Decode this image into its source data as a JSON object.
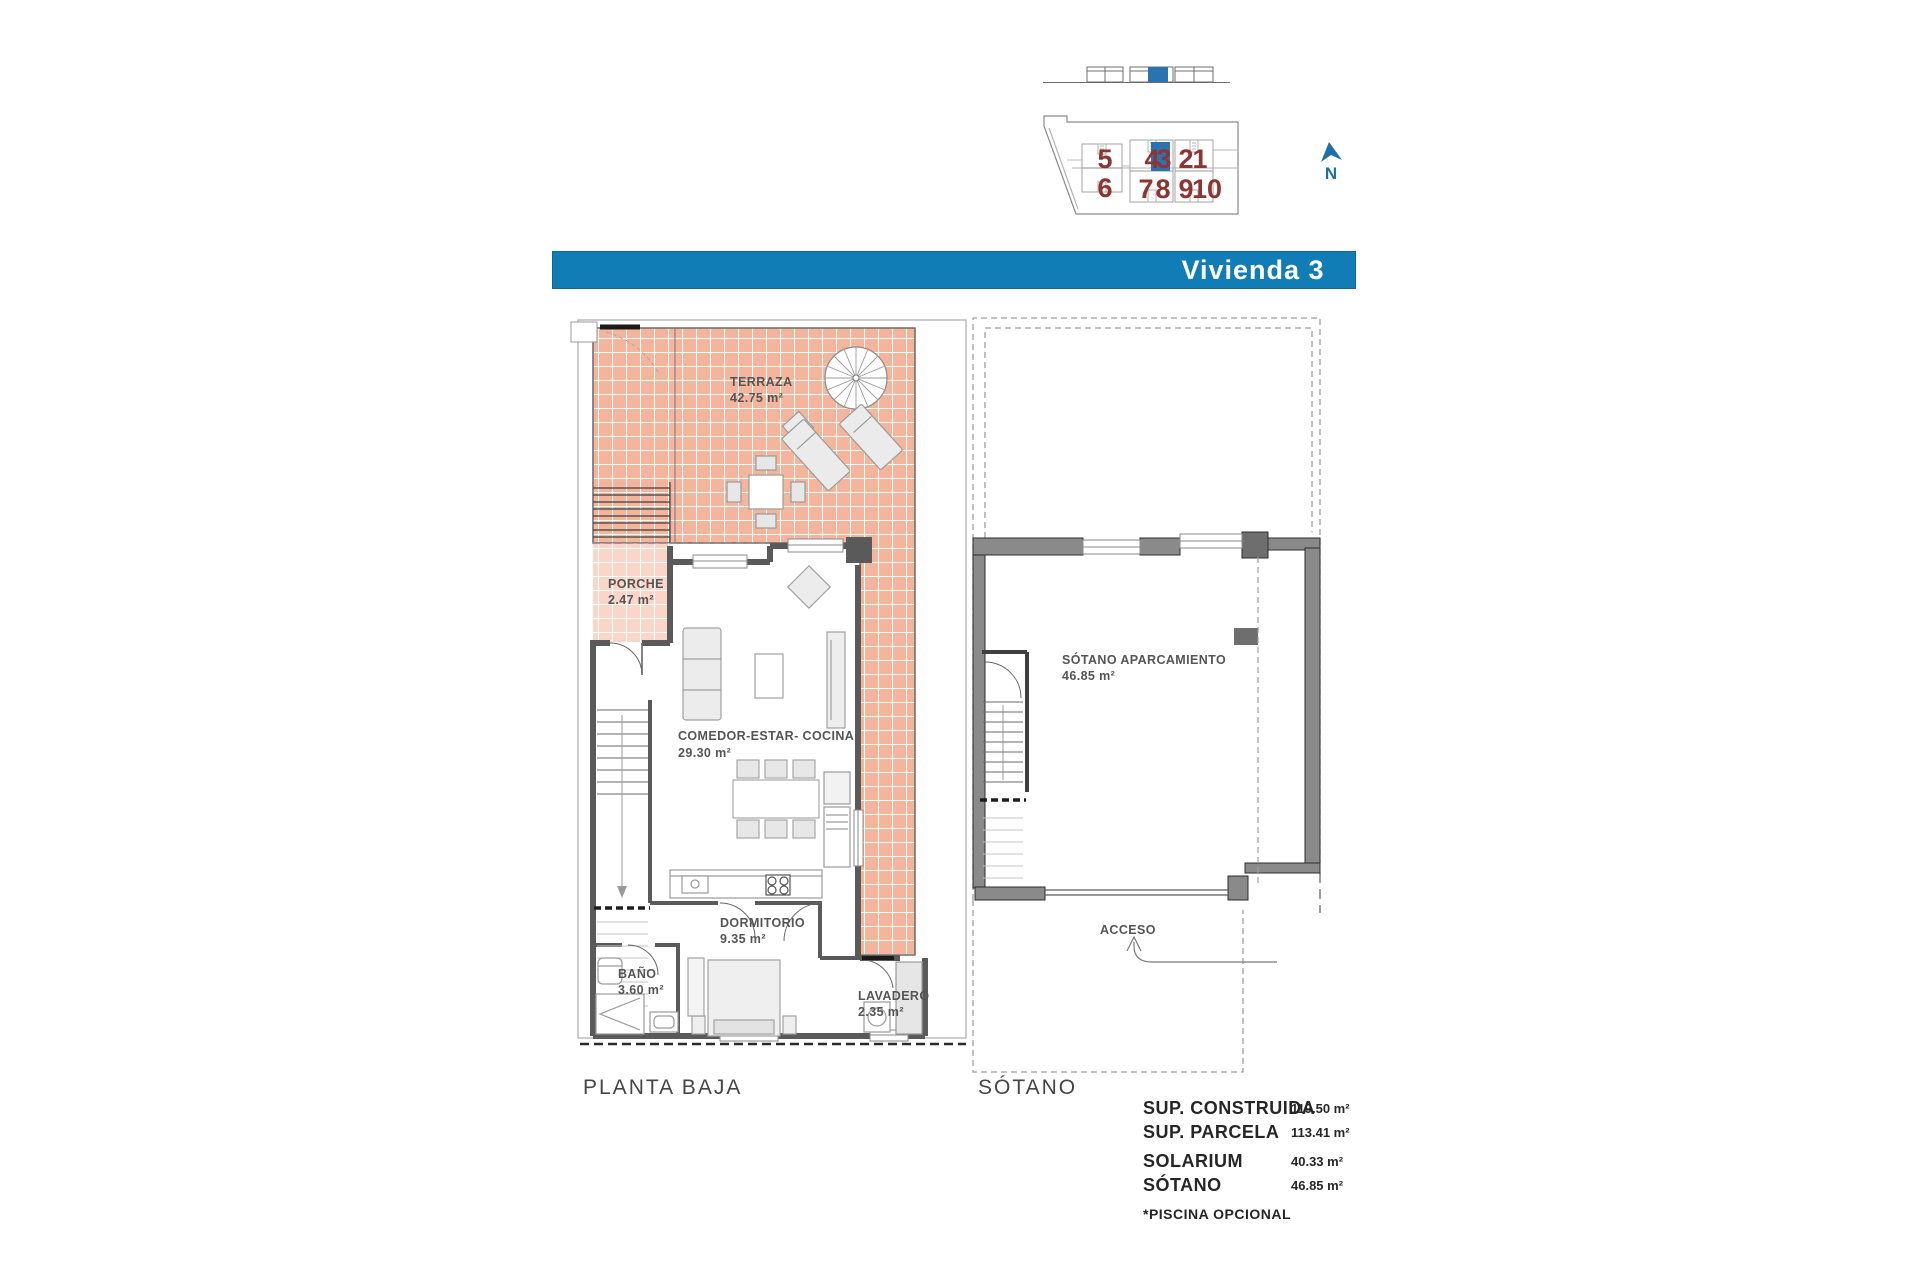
{
  "header": {
    "title": "Vivienda 3",
    "bar_color": "#117db6"
  },
  "site_plan": {
    "units_row1": [
      "5",
      "4",
      "3",
      "2",
      "1"
    ],
    "units_row2": [
      "7",
      "8",
      "9",
      "10"
    ],
    "unit_left_top": "5",
    "unit_left_bottom": "6",
    "highlighted_unit": "3",
    "north_label": "N",
    "number_color": "#8e3431",
    "highlight_color": "#2a72b0"
  },
  "ground_floor": {
    "caption": "PLANTA BAJA",
    "rooms": {
      "terraza": {
        "name": "TERRAZA",
        "area": "42.75 m²"
      },
      "porche": {
        "name": "PORCHE",
        "area": "2.47 m²"
      },
      "salon": {
        "name": "COMEDOR-ESTAR- COCINA",
        "area": "29.30 m²"
      },
      "dormitorio": {
        "name": "DORMITORIO",
        "area": "9.35 m²"
      },
      "bano": {
        "name": "BAÑO",
        "area": "3.60 m²"
      },
      "lavadero": {
        "name": "LAVADERO",
        "area": "2.35 m²"
      }
    }
  },
  "basement": {
    "caption": "SÓTANO",
    "room": {
      "name": "SÓTANO APARCAMIENTO",
      "area": "46.85 m²"
    },
    "access_label": "ACCESO"
  },
  "summary": {
    "rows": [
      {
        "label": "SUP. CONSTRUIDA",
        "value": "119.50 m²"
      },
      {
        "label": "SUP. PARCELA",
        "value": "113.41 m²"
      },
      {
        "label": "SOLARIUM",
        "value": "40.33 m²"
      },
      {
        "label": "SÓTANO",
        "value": "46.85 m²"
      }
    ],
    "note": "*PISCINA OPCIONAL"
  },
  "colors": {
    "tile": "#f5b59c",
    "wall_ground": "#5a5a5a",
    "wall_basement": "#8a8a8a"
  }
}
